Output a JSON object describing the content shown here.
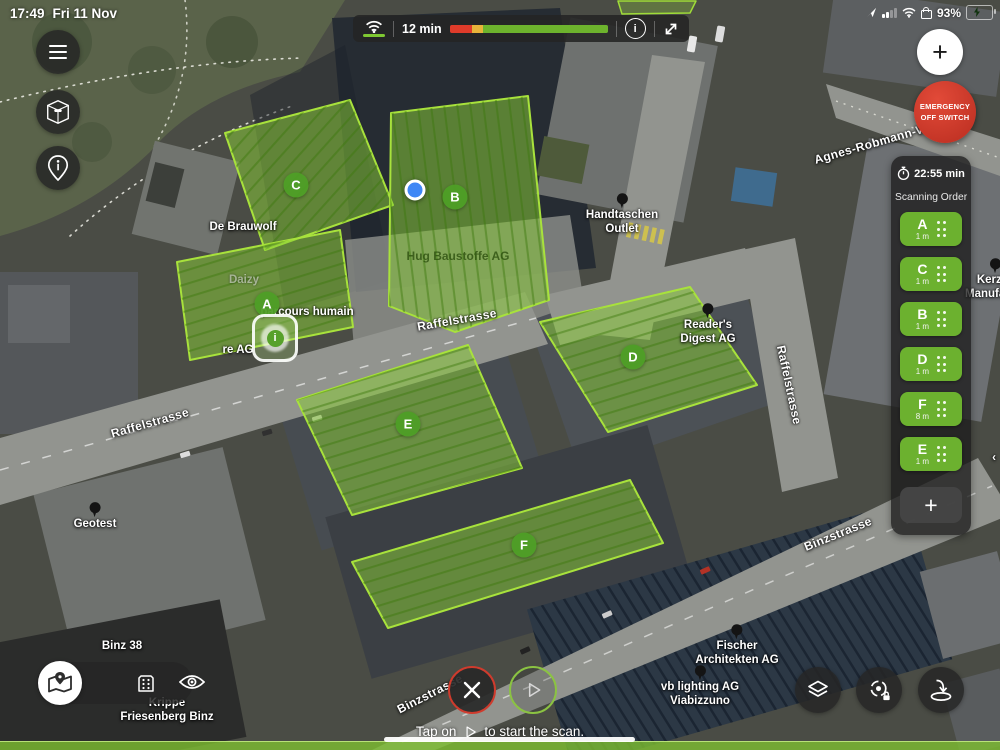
{
  "device_status": {
    "time": "17:49",
    "date": "Fri 11 Nov",
    "battery": "93%"
  },
  "flight_bar": {
    "remaining": "12 min",
    "battery_red_pct": 14,
    "battery_yellow_pct": 7,
    "battery_green_pct": 79
  },
  "emergency": {
    "line1": "EMERGENCY",
    "line2": "OFF SWITCH"
  },
  "mission_panel": {
    "eta": "22:55 min",
    "title": "Scanning Order",
    "add": "+",
    "items": [
      {
        "letter": "A",
        "gsd": "1 m"
      },
      {
        "letter": "C",
        "gsd": "1 m"
      },
      {
        "letter": "B",
        "gsd": "1 m"
      },
      {
        "letter": "D",
        "gsd": "1 m"
      },
      {
        "letter": "F",
        "gsd": "8 m"
      },
      {
        "letter": "E",
        "gsd": "1 m"
      }
    ]
  },
  "hint": {
    "prefix": "Tap on",
    "suffix": "to start the scan."
  },
  "map": {
    "location_dot": {
      "x": 415,
      "y": 190
    },
    "badges": [
      {
        "letter": "A",
        "x": 267,
        "y": 304
      },
      {
        "letter": "B",
        "x": 455,
        "y": 197
      },
      {
        "letter": "C",
        "x": 296,
        "y": 185
      },
      {
        "letter": "D",
        "x": 633,
        "y": 357
      },
      {
        "letter": "E",
        "x": 408,
        "y": 424
      },
      {
        "letter": "F",
        "x": 524,
        "y": 545
      }
    ],
    "labels": [
      {
        "lines": [
          "Agnes-Robmann-Weg"
        ],
        "x": 878,
        "y": 142,
        "rot": -16,
        "pin": false,
        "cls": "street"
      },
      {
        "lines": [
          "Handtaschen",
          "Outlet"
        ],
        "x": 622,
        "y": 215,
        "rot": 0,
        "pin": true,
        "cls": ""
      },
      {
        "lines": [
          "Reader's",
          "Digest AG"
        ],
        "x": 708,
        "y": 325,
        "rot": 0,
        "pin": true,
        "cls": ""
      },
      {
        "lines": [
          "Hug Baustoffe AG"
        ],
        "x": 458,
        "y": 256,
        "rot": 0,
        "pin": false,
        "cls": "dim"
      },
      {
        "lines": [
          "De Brauwolf"
        ],
        "x": 243,
        "y": 228,
        "rot": 0,
        "pin": false,
        "cls": ""
      },
      {
        "lines": [
          "Daizy"
        ],
        "x": 244,
        "y": 281,
        "rot": 0,
        "pin": false,
        "cls": "faint"
      },
      {
        "lines": [
          "parcours humain"
        ],
        "x": 307,
        "y": 313,
        "rot": 0,
        "pin": false,
        "cls": ""
      },
      {
        "lines": [
          "re AG"
        ],
        "x": 238,
        "y": 351,
        "rot": 0,
        "pin": false,
        "cls": ""
      },
      {
        "lines": [
          "Raffelstrasse"
        ],
        "x": 457,
        "y": 320,
        "rot": -10,
        "pin": false,
        "cls": "street"
      },
      {
        "lines": [
          "Raffelstrasse"
        ],
        "x": 150,
        "y": 423,
        "rot": -16,
        "pin": false,
        "cls": "street"
      },
      {
        "lines": [
          "Raffelstrasse"
        ],
        "x": 789,
        "y": 385,
        "rot": 78,
        "pin": false,
        "cls": "street"
      },
      {
        "lines": [
          "Binzstrasse"
        ],
        "x": 838,
        "y": 534,
        "rot": -22,
        "pin": false,
        "cls": "street"
      },
      {
        "lines": [
          "Binzstrasse"
        ],
        "x": 430,
        "y": 694,
        "rot": -27,
        "pin": false,
        "cls": "street"
      },
      {
        "lines": [
          "Geotest"
        ],
        "x": 95,
        "y": 517,
        "rot": 0,
        "pin": true,
        "cls": ""
      },
      {
        "lines": [
          "Binz 38"
        ],
        "x": 122,
        "y": 647,
        "rot": 0,
        "pin": false,
        "cls": ""
      },
      {
        "lines": [
          "Fischer",
          "Architekten AG"
        ],
        "x": 737,
        "y": 646,
        "rot": 0,
        "pin": true,
        "cls": ""
      },
      {
        "lines": [
          "vb lighting AG",
          "Viabizzuno"
        ],
        "x": 700,
        "y": 687,
        "rot": 0,
        "pin": true,
        "cls": ""
      },
      {
        "lines": [
          "Krippe",
          "Friesenberg Binz"
        ],
        "x": 167,
        "y": 711,
        "rot": 0,
        "pin": false,
        "cls": ""
      },
      {
        "lines": [
          "Kerzen",
          "Manufaktur"
        ],
        "x": 996,
        "y": 280,
        "rot": 0,
        "pin": true,
        "cls": ""
      },
      {
        "lines": [
          "‹"
        ],
        "x": 994,
        "y": 459,
        "rot": 0,
        "pin": false,
        "cls": ""
      }
    ]
  },
  "colors": {
    "accent_green": "#6cb12f",
    "area_fill": "rgba(139,206,56,0.52)",
    "area_stroke": "#a8e23c",
    "emergency_red": "#c9352a",
    "battery_red": "#df3b2a",
    "battery_yellow": "#e8b33a",
    "battery_green": "#6db32d",
    "location_blue": "#3f87f5"
  }
}
